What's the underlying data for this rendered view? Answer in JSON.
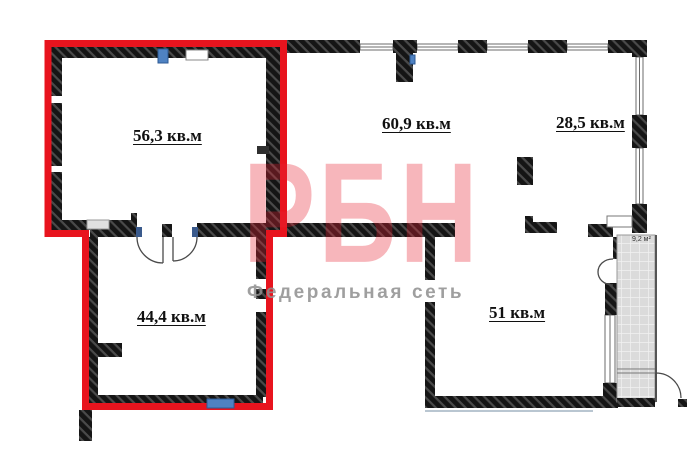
{
  "plan": {
    "rooms": [
      {
        "name": "room-top-left",
        "label": "56,3 кв.м",
        "highlighted": true
      },
      {
        "name": "room-top-middle",
        "label": "60,9 кв.м",
        "highlighted": false
      },
      {
        "name": "room-top-right",
        "label": "28,5 кв.м",
        "highlighted": false
      },
      {
        "name": "room-bottom-left",
        "label": "44,4 кв.м",
        "highlighted": true
      },
      {
        "name": "room-bottom-right",
        "label": "51 кв.м",
        "highlighted": false
      },
      {
        "name": "balcony",
        "label": "9,2 м²",
        "highlighted": false
      }
    ]
  },
  "watermark": {
    "logo": "РБН",
    "tagline": "Федеральная сеть"
  },
  "colors": {
    "highlight_red": "#e8141e",
    "wall_black": "#151515",
    "radiator_blue": "#4f82c2",
    "balcony_tile": "#dbdbdb",
    "watermark_pink": "#e72434",
    "tagline_gray": "#8f8f8f",
    "door_arc_gray": "#4a4a4a"
  }
}
